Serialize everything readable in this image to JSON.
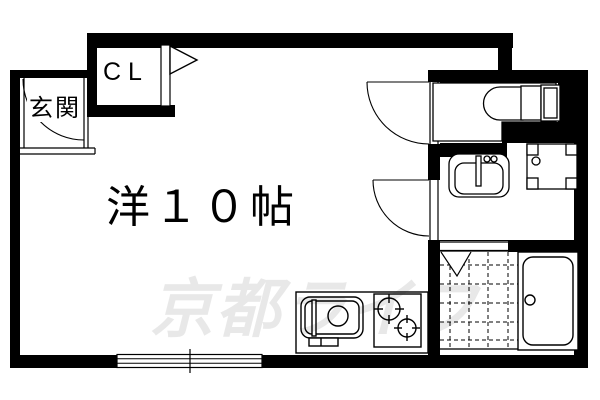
{
  "canvas": {
    "width": 600,
    "height": 400,
    "background_color": "#ffffff",
    "wall_color": "#000000",
    "line_color": "#000000",
    "watermark_color": "rgba(0,0,0,0.09)"
  },
  "labels": {
    "main_room": "洋１０帖",
    "entrance": "玄関",
    "closet": "CL"
  },
  "watermark": {
    "text": "京都ライフ"
  },
  "fixtures": [
    "toilet-icon",
    "washbasin-icon",
    "washing-machine-pan-icon",
    "bathtub-icon",
    "bathroom-tile-grid",
    "folding-door-icon",
    "kitchen-sink-icon",
    "stove-two-burner-icon",
    "sliding-window-icon",
    "door-swing-arc",
    "closet-door-triangle-icon"
  ]
}
